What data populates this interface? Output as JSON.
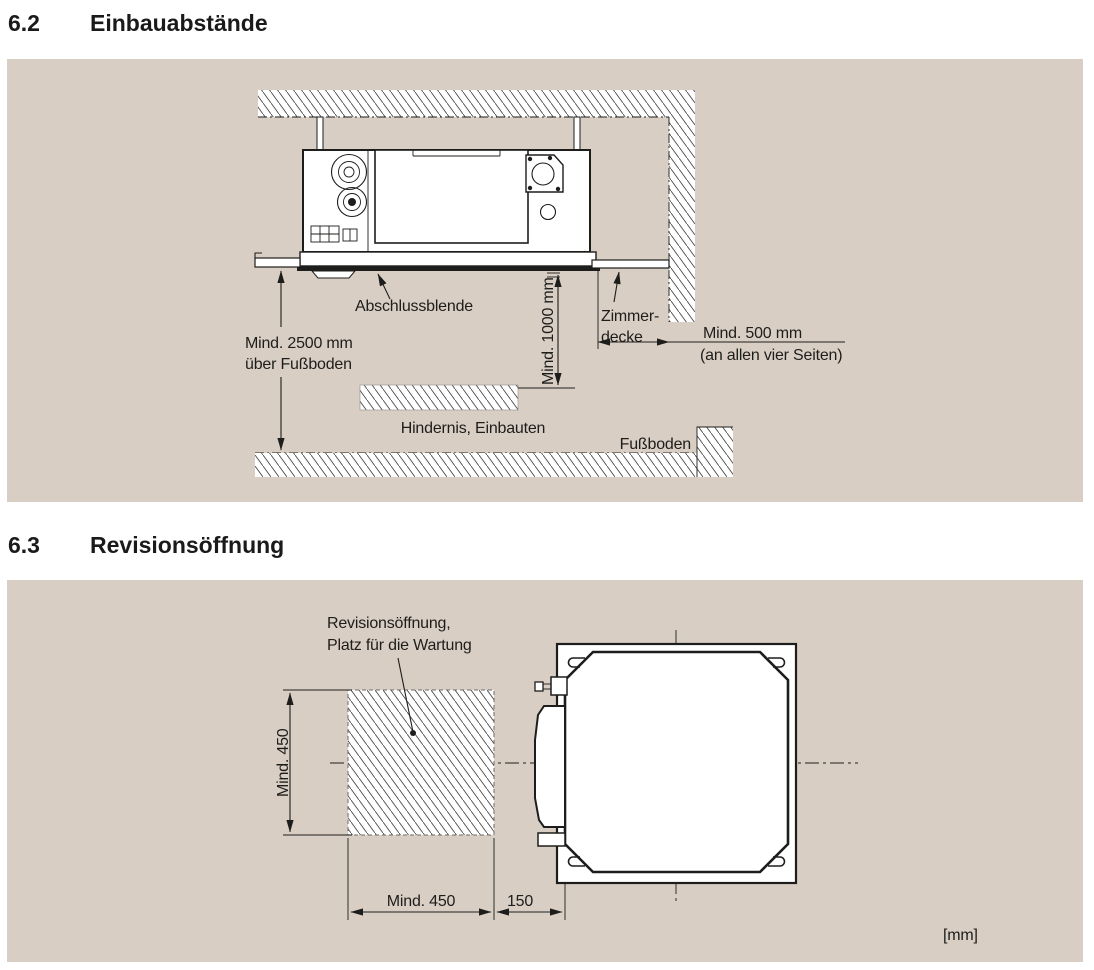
{
  "page": {
    "bg": "#ffffff",
    "panel_bg": "#d9cec4",
    "line_color": "#1d1d1b"
  },
  "sections": [
    {
      "number": "6.2",
      "title": "Einbauabstände"
    },
    {
      "number": "6.3",
      "title": "Revisionsöffnung"
    }
  ],
  "diagram_einbau": {
    "labels": {
      "abschlussblende": "Abschlussblende",
      "min_floor_1": "Mind. 2500 mm",
      "min_floor_2": "über Fußboden",
      "min_below": "Mind. 1000 mm",
      "zimmerdecke_1": "Zimmer-",
      "zimmerdecke_2": "decke",
      "min_side": "Mind. 500 mm",
      "min_side_note": "(an allen vier Seiten)",
      "hindernis": "Hindernis, Einbauten",
      "fussboden": "Fußboden"
    }
  },
  "diagram_revision": {
    "labels": {
      "revision_1": "Revisionsöffnung,",
      "revision_2": "Platz für die Wartung",
      "min_left": "Mind. 450",
      "min_bottom": "Mind. 450",
      "offset_150": "150",
      "units": "[mm]"
    }
  }
}
